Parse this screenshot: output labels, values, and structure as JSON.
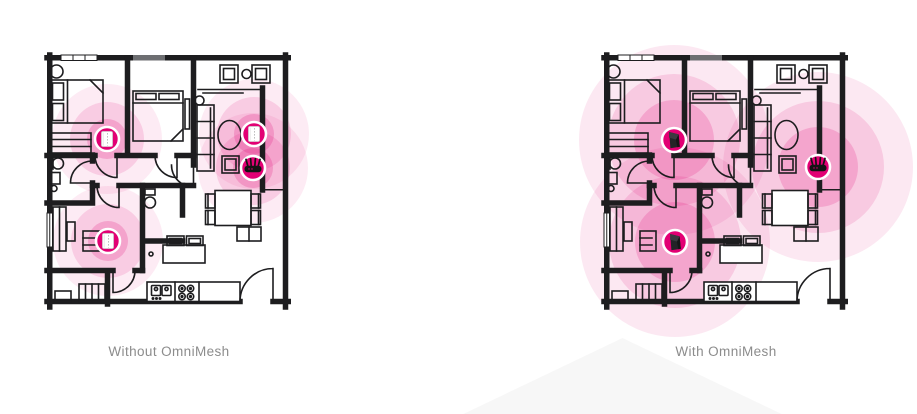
{
  "page": {
    "width": 917,
    "height": 414,
    "background": "#ffffff"
  },
  "brand": {
    "magenta": "#e20074",
    "coverage_color": "#e20074",
    "wall_color": "#1d1d1f",
    "label_color": "#8c8c8c",
    "triangle_color": "#f7f7f7"
  },
  "panels": [
    {
      "id": "without",
      "label": "Without OmniMesh",
      "coverage": {
        "radii": [
          55,
          37,
          20
        ],
        "opacities": [
          0.08,
          0.13,
          0.2
        ]
      },
      "devices": [
        {
          "type": "extender",
          "name": "wifi-extender-bedroom1",
          "x": 60,
          "y": 84
        },
        {
          "type": "extender",
          "name": "wifi-extender-living-room",
          "x": 207,
          "y": 79
        },
        {
          "type": "router",
          "name": "wifi-router-living-room",
          "x": 206,
          "y": 113
        },
        {
          "type": "extender",
          "name": "wifi-extender-bedroom3",
          "x": 61,
          "y": 186
        }
      ]
    },
    {
      "id": "with",
      "label": "With OmniMesh",
      "coverage": {
        "radii": [
          95,
          66,
          40
        ],
        "opacities": [
          0.09,
          0.13,
          0.18
        ]
      },
      "devices": [
        {
          "type": "mesh",
          "name": "mesh-node-bedroom1",
          "x": 70,
          "y": 85
        },
        {
          "type": "router",
          "name": "wifi-router-living-room",
          "x": 214,
          "y": 112
        },
        {
          "type": "mesh",
          "name": "mesh-node-bedroom3",
          "x": 71,
          "y": 187
        }
      ]
    }
  ]
}
